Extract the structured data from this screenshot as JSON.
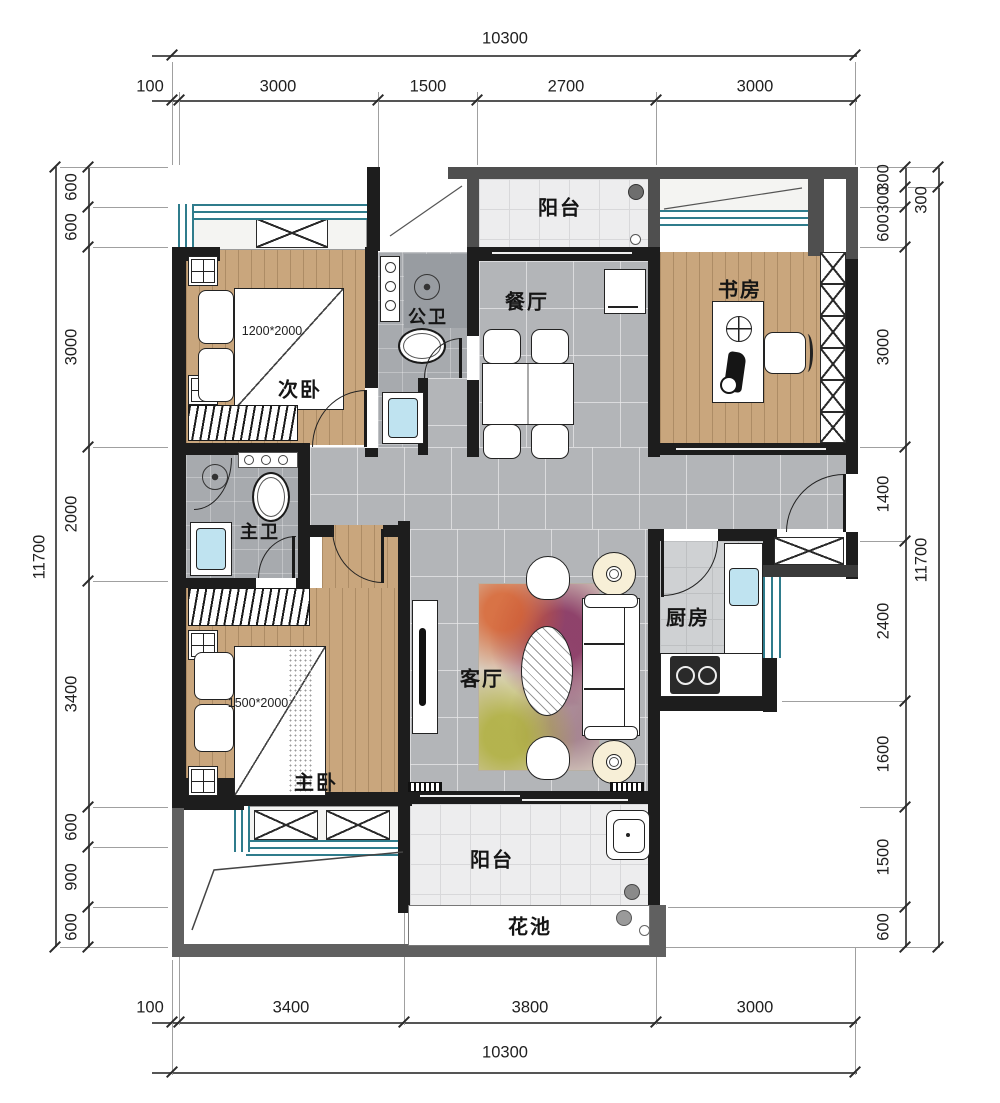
{
  "plan": {
    "rooms": {
      "balcony_top": {
        "label": "阳台"
      },
      "dining": {
        "label": "餐厅"
      },
      "study": {
        "label": "书房"
      },
      "bath_public": {
        "label": "公卫"
      },
      "bedroom_second": {
        "label": "次卧",
        "bed": "1200*2000"
      },
      "bath_master": {
        "label": "主卫"
      },
      "kitchen": {
        "label": "厨房"
      },
      "living": {
        "label": "客厅"
      },
      "bedroom_master": {
        "label": "主卧",
        "bed": "1500*2000"
      },
      "balcony_bottom": {
        "label": "阳台"
      },
      "flower_bed": {
        "label": "花池"
      }
    },
    "colors": {
      "wall": "#1d1d1d",
      "window": "#2f7c8c",
      "wood_floor": "#c9a67d",
      "gray_tile": "#b3b5b8",
      "sink_blue": "#bfe3f0"
    }
  },
  "dimensions": {
    "top": {
      "total": "10300",
      "segments": [
        "100",
        "3000",
        "1500",
        "2700",
        "3000"
      ]
    },
    "bottom": {
      "total": "10300",
      "segments": [
        "100",
        "3400",
        "3800",
        "3000"
      ]
    },
    "left": {
      "total": "11700",
      "segments": [
        "600",
        "600",
        "3000",
        "2000",
        "3400",
        "600",
        "900",
        "600"
      ]
    },
    "right": {
      "outer_top": "300",
      "outer_total": "11700",
      "segments": [
        "300",
        "300",
        "600",
        "3000",
        "1400",
        "2400",
        "1600",
        "1500",
        "600"
      ]
    }
  }
}
